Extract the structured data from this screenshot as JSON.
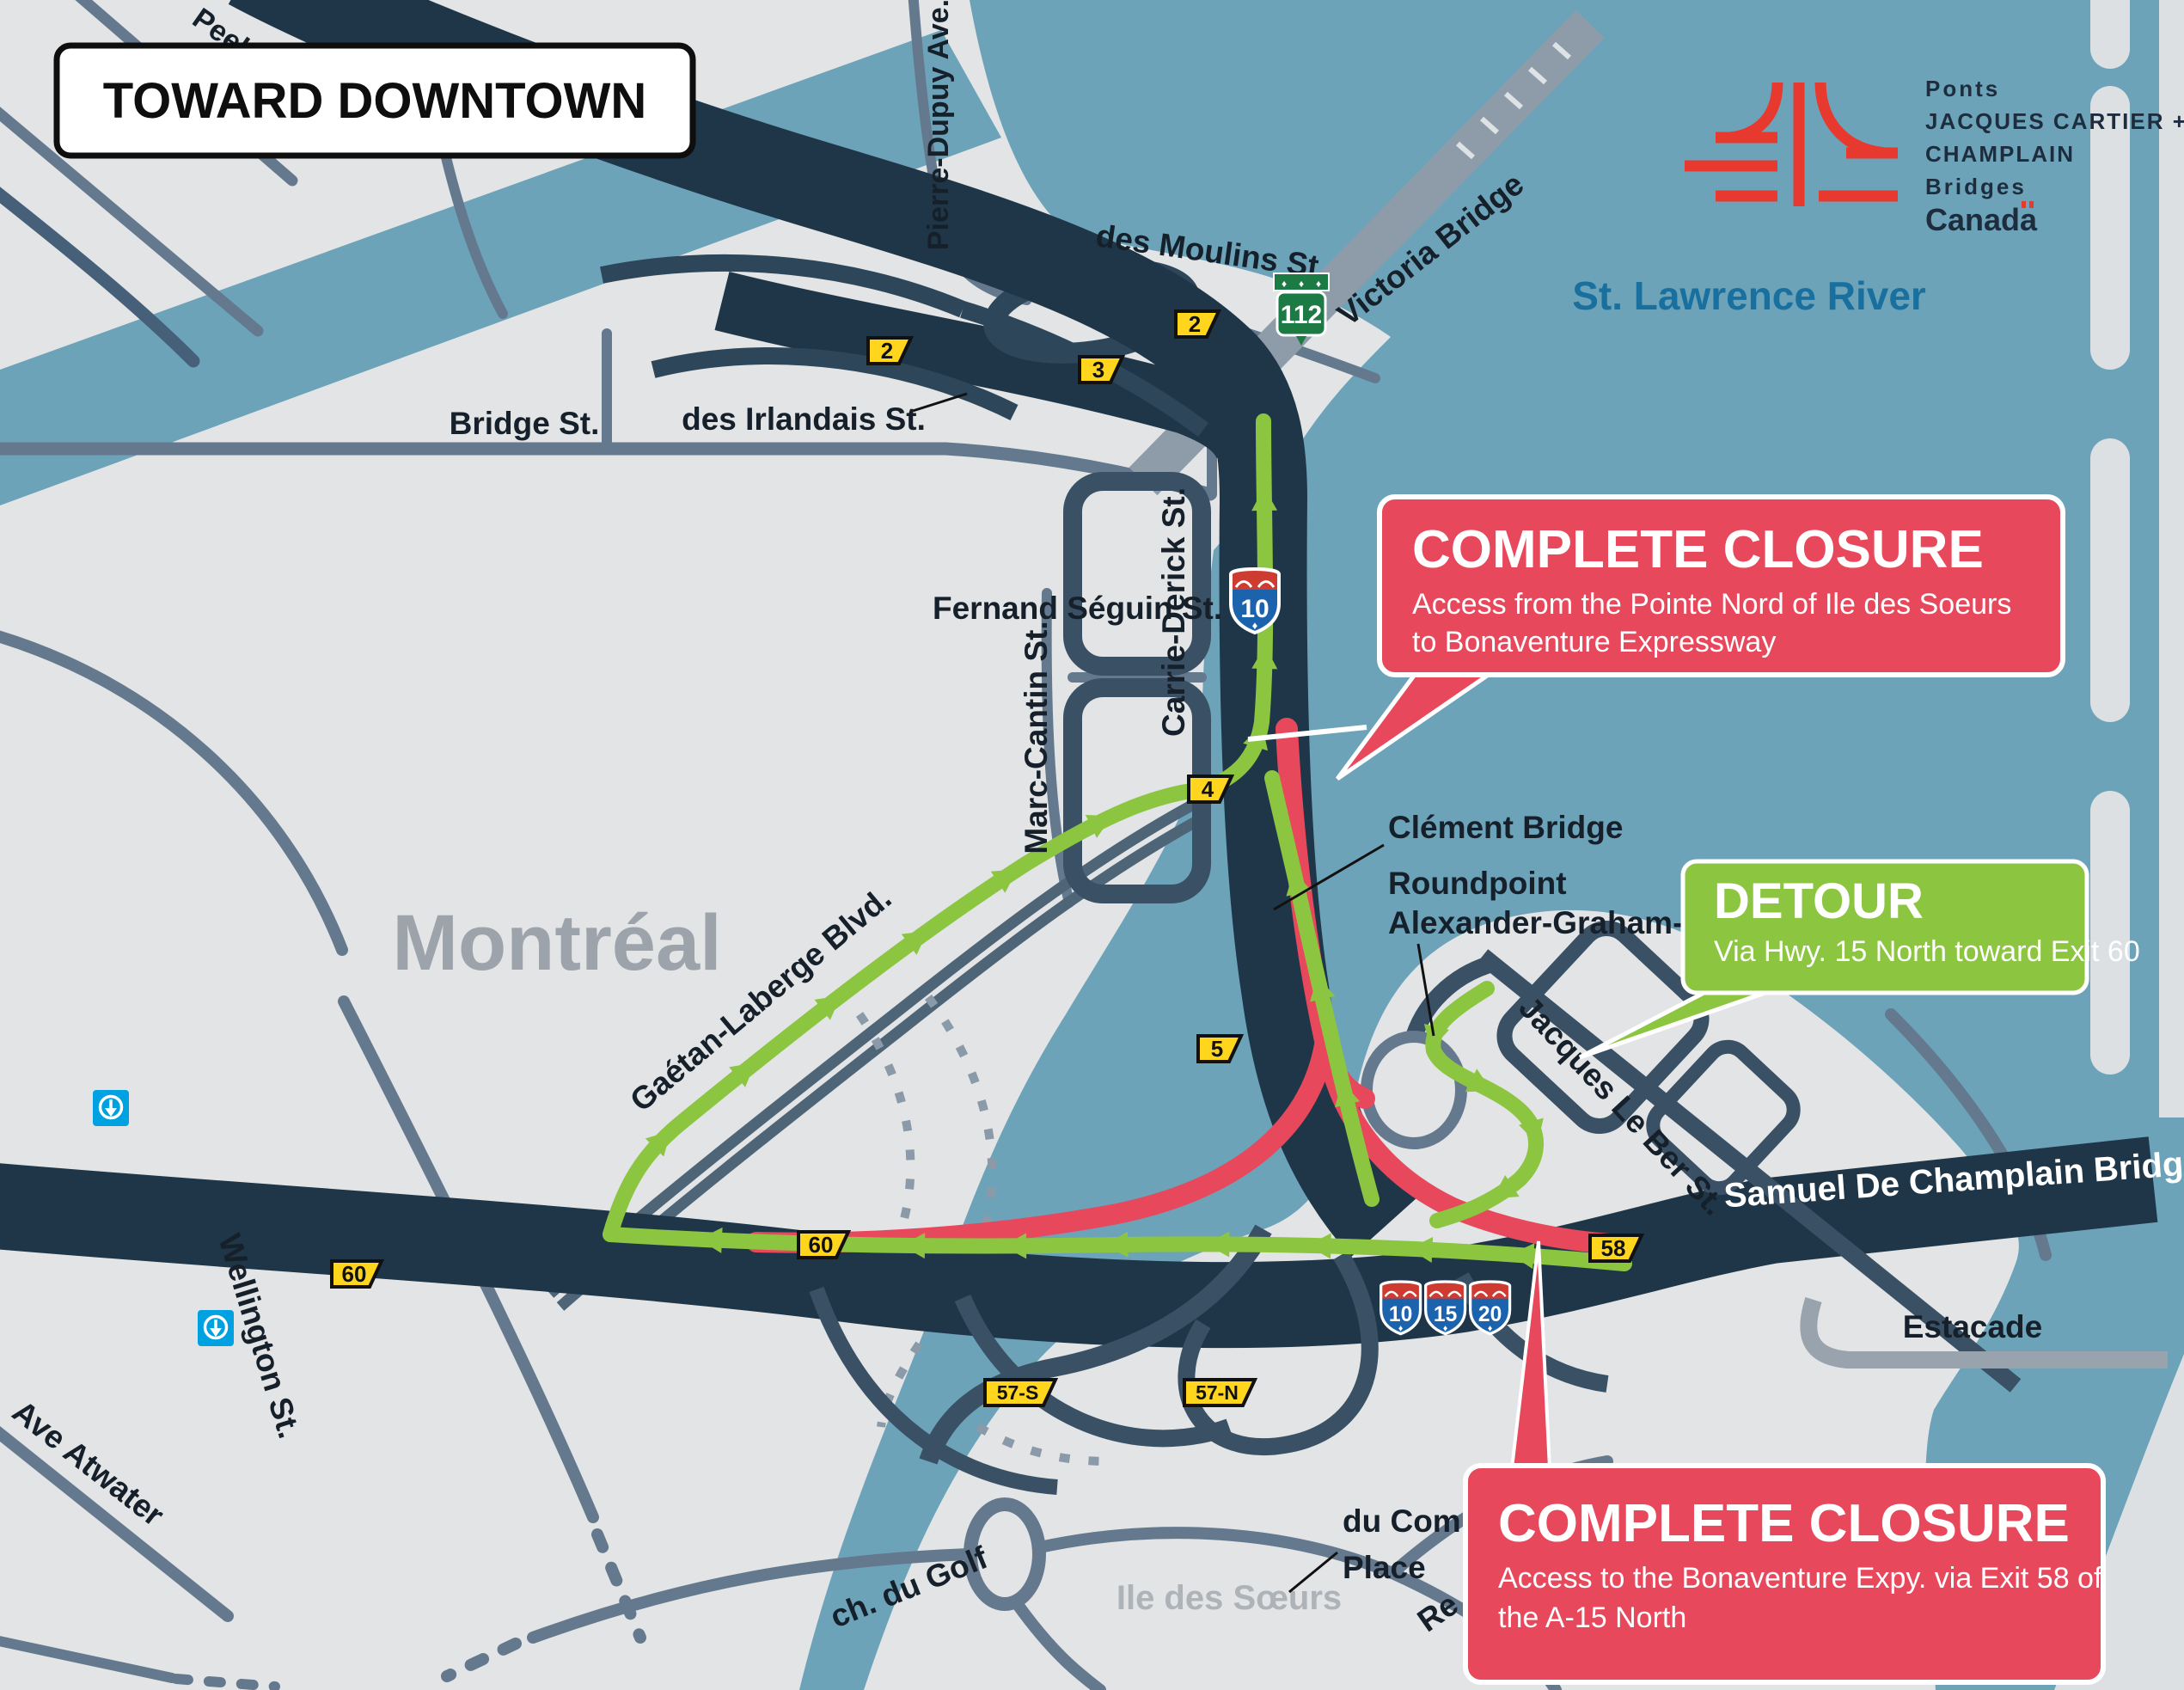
{
  "banner": {
    "label": "TOWARD DOWNTOWN"
  },
  "logo": {
    "org_fr": "Ponts",
    "org_line2": "JACQUES CARTIER +",
    "org_line3": "CHAMPLAIN",
    "org_en": "Bridges",
    "gov": "Canada"
  },
  "labels": {
    "river": "St. Lawrence River",
    "city": "Montréal",
    "island": "Ile des Sœurs",
    "peel": "Peel St.",
    "pierre_dupuy": "Pierre-Dupuy Ave.",
    "des_moulins": "des Moulins St.",
    "victoria_bridge": "Victoria Bridge",
    "bridge_st": "Bridge St.",
    "des_irlandais": "des Irlandais St.",
    "fernand_seguin": "Fernand Séguin St.",
    "carrie_derick": "Carrie-Derick St.",
    "marc_cantin": "Marc-Cantin St.",
    "gaetan_laberge": "Gaétan-Laberge Blvd.",
    "wellington": "Wellington St.",
    "ave_atwater": "Ave Atwater",
    "ch_du_golf": "ch. du Golf",
    "jacques_le_ber": "Jacques Le Ber St.",
    "clement_bridge": "Clément Bridge",
    "roundpoint_line1": "Roundpoint",
    "roundpoint_line2": "Alexander-Graham-Bell",
    "champlain_bridge": "Samuel De Champlain Bridge",
    "estacade": "Estacade",
    "commerce_line1": "du Com",
    "commerce_line2": "Place",
    "partial_re": "Re"
  },
  "callouts": {
    "closure_north": {
      "title": "COMPLETE CLOSURE",
      "lines": [
        "Access from the Pointe Nord of Ile des Soeurs",
        "to Bonaventure Expressway"
      ]
    },
    "detour": {
      "title": "DETOUR",
      "lines": [
        "Via Hwy. 15 North toward Exit 60"
      ]
    },
    "closure_south": {
      "title": "COMPLETE CLOSURE",
      "lines": [
        "Access to the Bonaventure Expy. via Exit 58 of",
        "the A-15 North"
      ]
    }
  },
  "markers": {
    "exits": [
      {
        "label": "2"
      },
      {
        "label": "3"
      },
      {
        "label": "2"
      },
      {
        "label": "4"
      },
      {
        "label": "5"
      },
      {
        "label": "60"
      },
      {
        "label": "60"
      },
      {
        "label": "57-S"
      },
      {
        "label": "57-N"
      },
      {
        "label": "58"
      }
    ],
    "shields": {
      "a10_top": "10",
      "a10": "10",
      "a15": "15",
      "a20": "20",
      "q112": "112"
    }
  },
  "colors": {
    "water": "#6CA3B9",
    "land": "#E2E4E6",
    "expressway_navy": "#1F3648",
    "road_slate": "#64798E",
    "road_dark": "#3A5064",
    "closure_red": "#E8485C",
    "detour_green": "#8CC540",
    "exit_yellow": "#FFD51E",
    "metro_blue": "#00A1E0",
    "river_text": "#19709F",
    "logo_red": "#E8392F"
  }
}
